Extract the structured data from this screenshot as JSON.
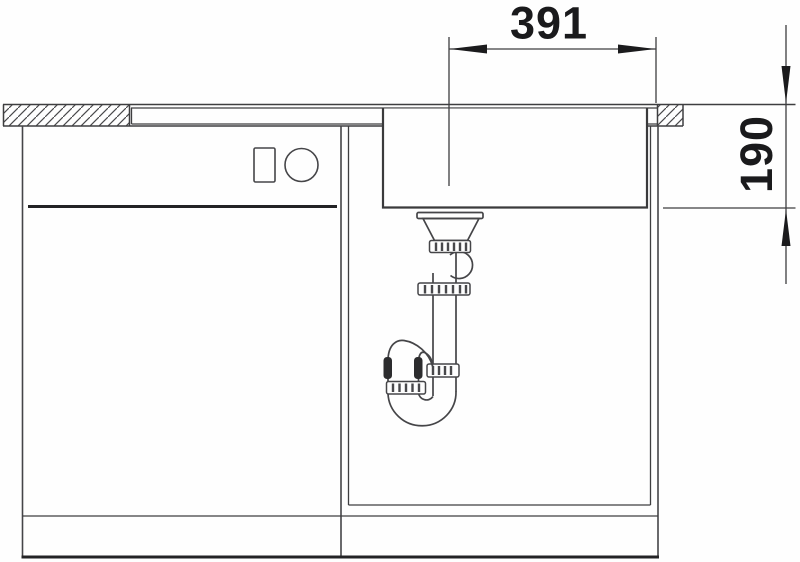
{
  "drawing": {
    "dimensions": {
      "width": {
        "value": "391"
      },
      "depth": {
        "value": "190"
      }
    }
  },
  "colors": {
    "line": "#3e3e40",
    "dark": "#1b1b1d",
    "background": "#fefefe"
  }
}
